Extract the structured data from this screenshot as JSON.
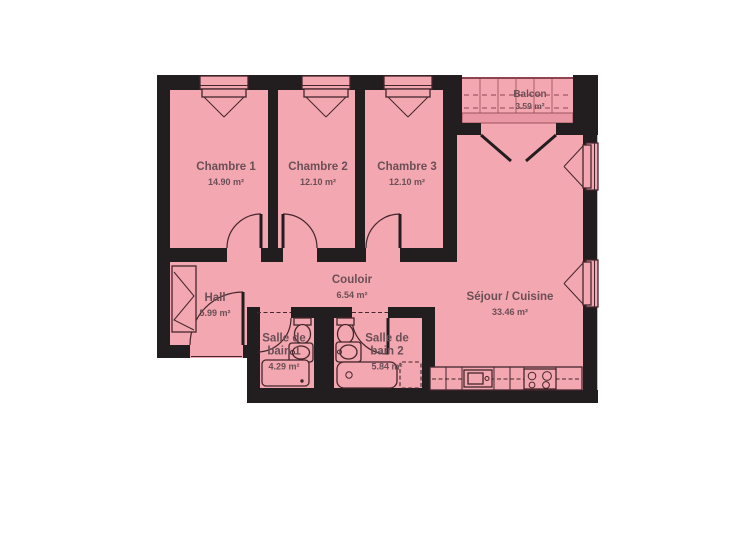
{
  "colors": {
    "floor": "#f3a7b0",
    "floor_dark": "#e897a3",
    "wall": "#221d1f",
    "line": "#44262c",
    "balcony_line": "#8d4350",
    "text": "#6b4f57",
    "background": "#ffffff"
  },
  "rooms": [
    {
      "id": "chambre-1",
      "name": "Chambre 1",
      "area": "14.90 m²"
    },
    {
      "id": "chambre-2",
      "name": "Chambre 2",
      "area": "12.10 m²"
    },
    {
      "id": "chambre-3",
      "name": "Chambre 3",
      "area": "12.10 m²"
    },
    {
      "id": "balcon",
      "name": "Balcon",
      "area": "3.59 m²"
    },
    {
      "id": "sejour-cuisine",
      "name": "Séjour / Cuisine",
      "area": "33.46 m²"
    },
    {
      "id": "couloir",
      "name": "Couloir",
      "area": "6.54 m²"
    },
    {
      "id": "hall",
      "name": "Hall",
      "area": "5.99 m²"
    },
    {
      "id": "salle-de-bain-1",
      "name": "Salle de bain 1",
      "area": "4.29 m²"
    },
    {
      "id": "salle-de-bain-2",
      "name": "Salle de bain 2",
      "area": "5.84 m²"
    }
  ],
  "symbols": [
    "window",
    "door-swing",
    "french-door",
    "balcony-railing",
    "closet",
    "toilet",
    "sink",
    "shower",
    "bathtub",
    "washing-machine",
    "kitchen-counter",
    "kitchen-sink",
    "stove"
  ]
}
